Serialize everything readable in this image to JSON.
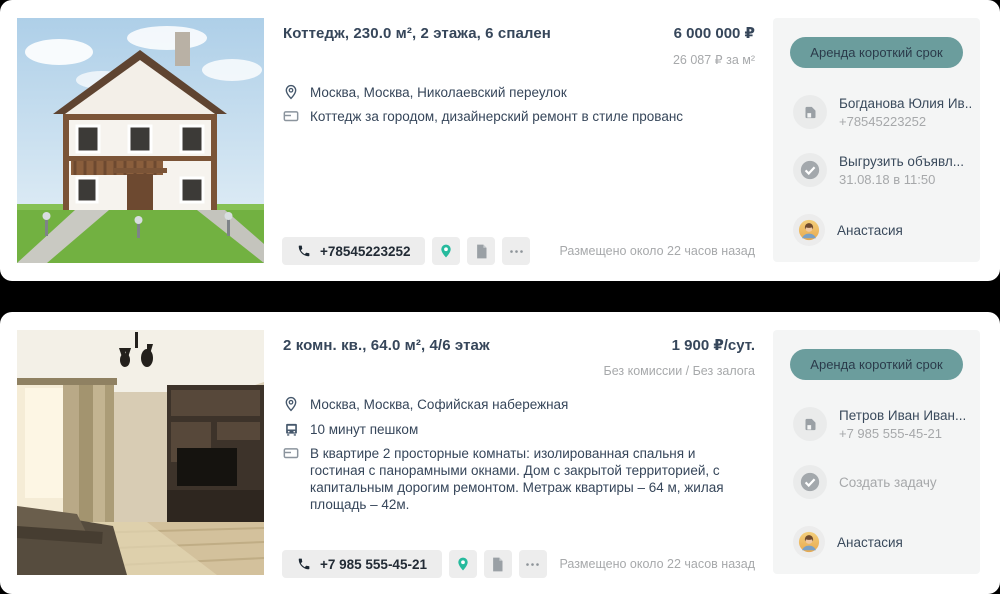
{
  "colors": {
    "background": "#000000",
    "card_bg": "#ffffff",
    "accent_teal_pill": "#6b9d9d",
    "accent_green_pin": "#26ba9d",
    "text_dark": "#36465a",
    "text_gray": "#a7a9ab",
    "panel_bg": "#f4f5f5",
    "button_bg": "#ededed"
  },
  "listings": [
    {
      "title": "Коттедж, 230.0 м², 2 этажа, 6 спален",
      "price": "6 000 000 ₽",
      "price_note": "26 087 ₽ за м²",
      "location": "Москва, Москва, Николаевский переулок",
      "summary": "Коттедж за городом, дизайнерский ремонт в стиле прованс",
      "phone_button": "+78545223252",
      "posted": "Размещено около 22 часов назад",
      "sidebar": {
        "tag": "Аренда короткий срок",
        "contact_name": "Богданова Юлия Ив...",
        "contact_phone": "+78545223252",
        "task_label": "Выгрузить объявл...",
        "task_date": "31.08.18 в 11:50",
        "agent_name": "Анастасия"
      }
    },
    {
      "title": "2 комн. кв., 64.0 м², 4/6 этаж",
      "price": "1 900 ₽/сут.",
      "price_note": "Без комиссии / Без залога",
      "location": "Москва, Москва, Софийская набережная",
      "transport": "10 минут пешком",
      "summary": "В квартире 2 просторные комнаты: изолированная спальня и гостиная с панорамными окнами. Дом с закрытой территорией, с капитальным дорогим ремонтом. Метраж квартиры – 64 м, жилая площадь – 42м.",
      "phone_button": "+7 985 555-45-21",
      "posted": "Размещено около 22 часов назад",
      "sidebar": {
        "tag": "Аренда короткий срок",
        "contact_name": "Петров Иван Иван...",
        "contact_phone": "+7 985 555-45-21",
        "task_label": "Создать задачу",
        "agent_name": "Анастасия"
      }
    }
  ]
}
